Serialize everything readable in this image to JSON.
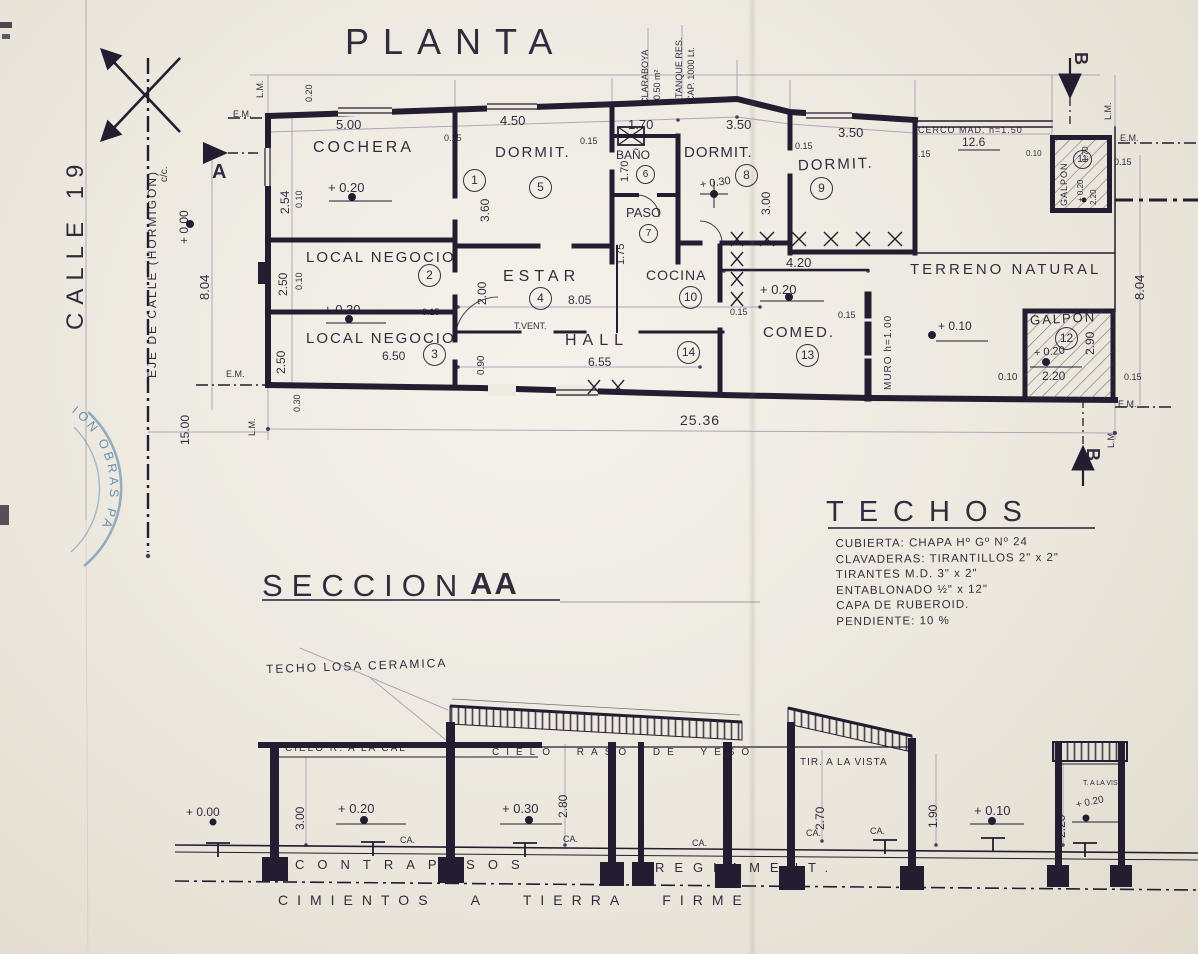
{
  "colors": {
    "ink": "#241c30",
    "ink_soft": "#4a3e5e",
    "construction": "#9a8fae",
    "stamp_blue": "#4a79a8",
    "paper": "#efeae0"
  },
  "plan": {
    "title": "PLANTA",
    "street_name": "CALLE 19",
    "street_axis": "EJE DE CALLE (HORMIGON)",
    "street_axis_sub": "c/c.",
    "marker_a": "A",
    "marker_b": "B",
    "lm": "L.M.",
    "em": "E.M.",
    "rooms": [
      {
        "label": "COCHERA",
        "num": "1"
      },
      {
        "label": "LOCAL NEGOCIO",
        "num": "2"
      },
      {
        "label": "LOCAL NEGOCIO",
        "num": "3"
      },
      {
        "label": "ESTAR",
        "num": "4"
      },
      {
        "label": "DORMIT.",
        "num": "5"
      },
      {
        "label": "BAÑO",
        "num": "6"
      },
      {
        "label": "PASO",
        "num": "7"
      },
      {
        "label": "DORMIT.",
        "num": "8"
      },
      {
        "label": "DORMIT.",
        "num": "9"
      },
      {
        "label": "COCINA",
        "num": "10"
      },
      {
        "label": "GALPON",
        "num": "11"
      },
      {
        "label": "GALPON",
        "num": "12"
      },
      {
        "label": "COMED.",
        "num": "13"
      },
      {
        "label": "HALL",
        "num": "14"
      }
    ],
    "annotations": {
      "terreno": "TERRENO NATURAL",
      "muro": "MURO h=1.00",
      "cerco": "CERCO MAD. h=1.50",
      "cerco_len": "12.6",
      "t_vent": "T.VENT.",
      "claraboya": "CLARABOYA",
      "claraboya_area": "0.50 m²",
      "tanque": "TANQUE RES.",
      "tanque_cap": "CAP. 1000 Lt."
    },
    "levels": {
      "street": "+ 0.00",
      "cochera": "+ 0.20",
      "local": "+ 0.30",
      "dormit": "+ 0.30",
      "comedor": "+ 0.20",
      "terreno": "+ 0.10",
      "galpon": "+ 0.20"
    },
    "dims": {
      "d500": "5.00",
      "d450": "4.50",
      "d170": "1.70",
      "d350": "3.50",
      "d254": "2.54",
      "d250": "2.50",
      "d360": "3.60",
      "d175": "1.75",
      "d300": "3.00",
      "d200": "2.00",
      "d805": "8.05",
      "d655": "6.55",
      "d650": "6.50",
      "d420": "4.20",
      "d090": "0.90",
      "d220": "2.20",
      "d290": "2.90",
      "total": "25.36",
      "depth": "8.04",
      "street_w": "15.00",
      "w15": "0.15",
      "w10": "0.10",
      "w30": "0.30",
      "w20": "0.20"
    }
  },
  "techos": {
    "title": "TECHOS",
    "lines": [
      "CUBIERTA: CHAPA Hº Gº Nº 24",
      "CLAVADERAS: TIRANTILLOS 2\" x 2\"",
      "TIRANTES M.D. 3\" x 2\"",
      "ENTABLONADO ½\" x 12\"",
      "CAPA DE RUBEROID.",
      "PENDIENTE: 10 %"
    ]
  },
  "seccion": {
    "title": "SECCION",
    "title_suffix": "AA",
    "techo_losa": "TECHO LOSA CERAMICA",
    "cielo_cal": "CIELO R. A LA CAL",
    "cielo_yeso": "CIELO RASO DE YESO",
    "tir_vista": "TIR. A LA VISTA",
    "t_vista": "T. A LA VIST.",
    "ca": "CA.",
    "dims": {
      "d300": "3.00",
      "d280": "2.80",
      "d270": "2.70",
      "d190": "1.90",
      "d220": "2.20"
    },
    "levels": {
      "street": "+ 0.00",
      "cochera": "+ 0.20",
      "casa": "+ 0.30",
      "patio": "+ 0.10",
      "galpon": "+ 0.20"
    },
    "contrapisos": "CONTRAPISOS",
    "reglament": "REGLAMENT.",
    "cimientos": "CIMIENTOS A TIERRA FIRME"
  },
  "stamp": {
    "text": "ION OBRAS PA"
  }
}
